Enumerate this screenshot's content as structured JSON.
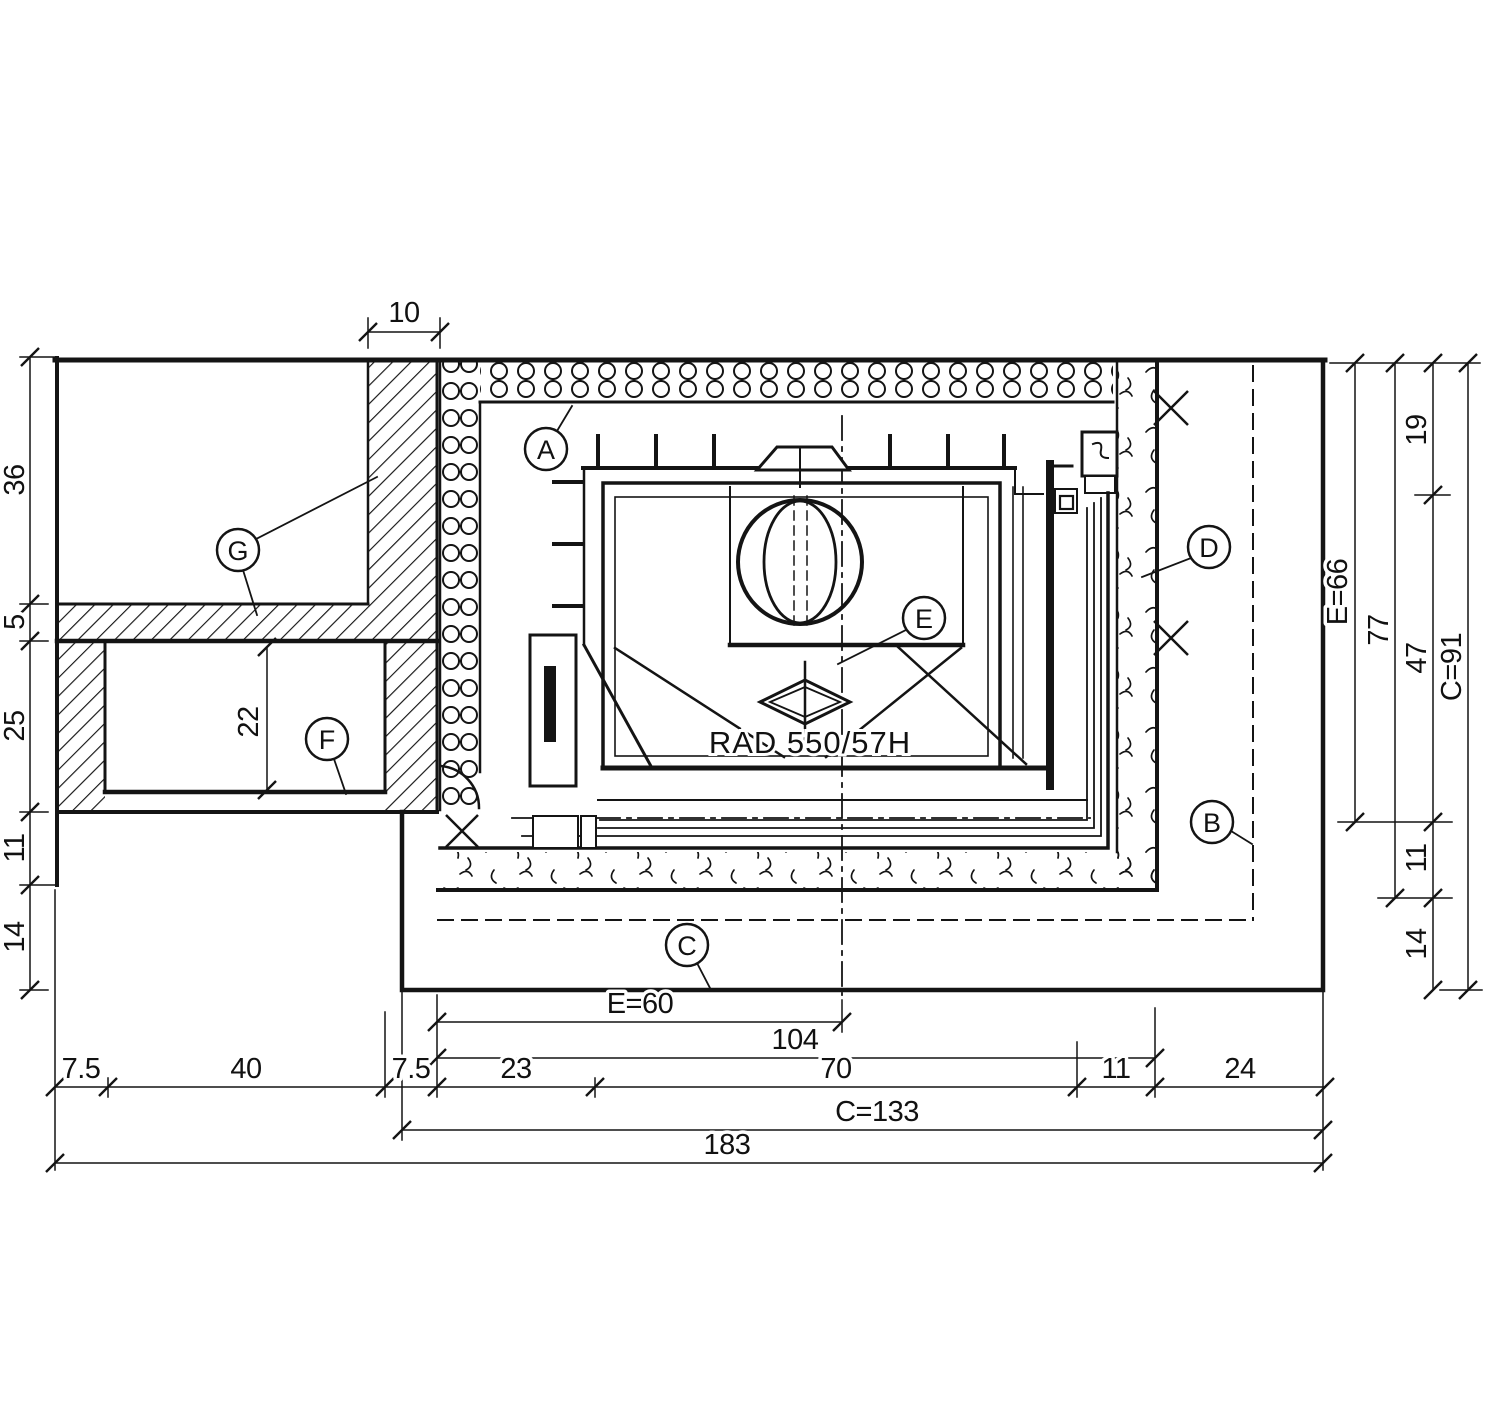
{
  "callouts": {
    "a": "A",
    "b": "B",
    "c": "C",
    "d": "D",
    "e": "E",
    "f": "F",
    "g": "G"
  },
  "stove": {
    "model_label": "RAD 550/57H"
  },
  "dimensions": {
    "top": {
      "wall_width": "10"
    },
    "left": {
      "chain": [
        "36",
        "5",
        "25",
        "11",
        "14"
      ],
      "niche_height": "22"
    },
    "right": {
      "e_height": "E=66",
      "height_77": "77",
      "chain": [
        "19",
        "47",
        "11",
        "14"
      ],
      "c_height": "C=91"
    },
    "bottom": {
      "e_width": "E=60",
      "width_104": "104",
      "row": [
        "7.5",
        "40",
        "7.5",
        "23",
        "70",
        "11",
        "24"
      ],
      "c_width": "C=133",
      "total_width": "183"
    }
  }
}
